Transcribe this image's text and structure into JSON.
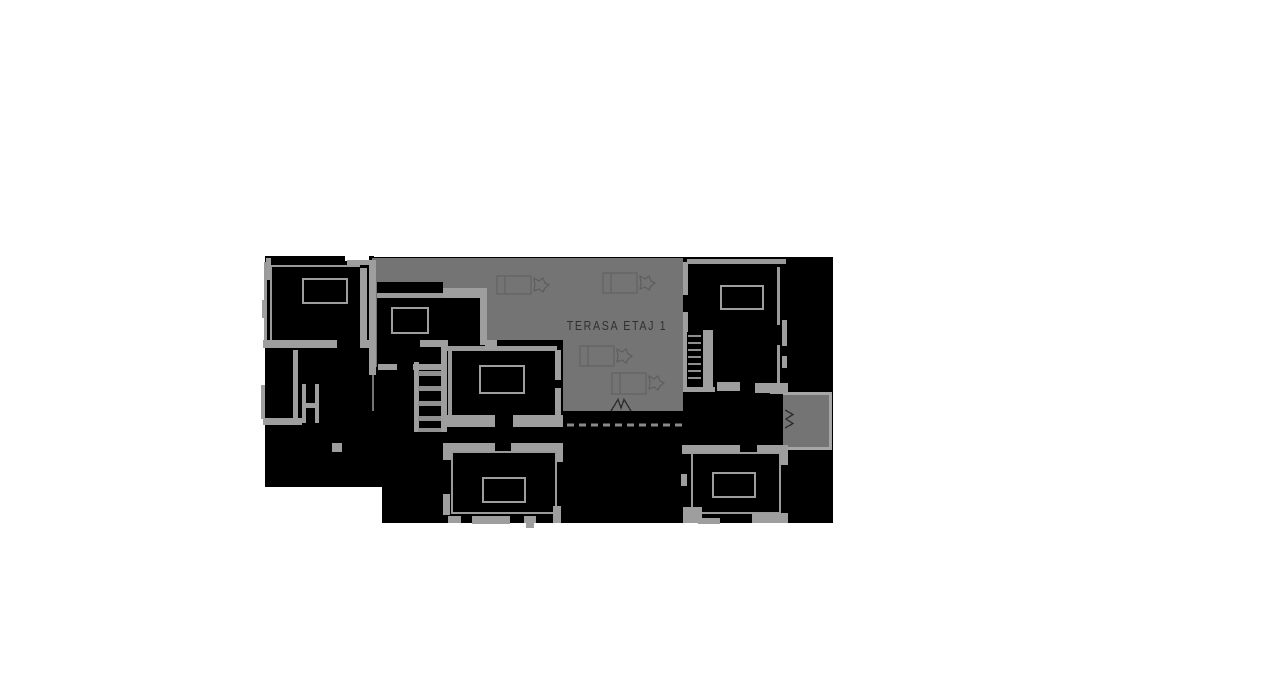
{
  "terrace": {
    "label": "TERASA ETAJ 1"
  },
  "colors": {
    "background": "#ffffff",
    "structure_fill": "#000000",
    "terrace": "#747474",
    "balcony": "#747474",
    "balcony_edge": "#a6a6a6",
    "walls": "#9e9e9e",
    "label": "#303030",
    "furniture": "#5e5e5e",
    "dashed_line": "#8a8a8a",
    "door_symbol": "#2e2e2e"
  },
  "icons": {
    "terrace_door": "double-door-swing-icon",
    "balcony_door": "double-door-swing-icon"
  }
}
